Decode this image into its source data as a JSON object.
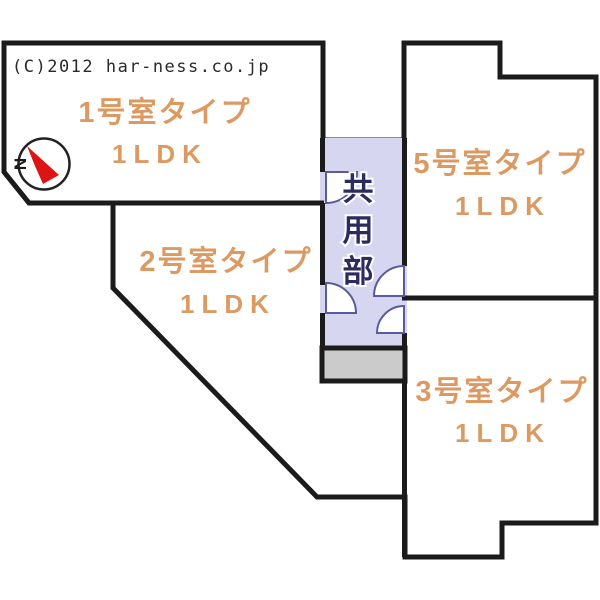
{
  "copyright": "(C)2012 har-ness.co.jp",
  "compass": {
    "north_label": "N"
  },
  "common_area": {
    "name": "共用部",
    "chars": [
      "共",
      "用",
      "部"
    ]
  },
  "rooms": [
    {
      "number": "1号室タイプ",
      "layout": "1LDK"
    },
    {
      "number": "2号室タイプ",
      "layout": "1LDK"
    },
    {
      "number": "3号室タイプ",
      "layout": "1LDK"
    },
    {
      "number": "5号室タイプ",
      "layout": "1LDK"
    }
  ],
  "colors": {
    "wall": "#1b1b1b",
    "room_label": "#dc9a62",
    "common_area_fill": "#d6d6f1",
    "common_area_label": "#2b2b5e",
    "stairs_fill": "#cbcbcb",
    "door_arc_stroke": "#5a5aa0",
    "compass_arrow": "#dd1414"
  }
}
